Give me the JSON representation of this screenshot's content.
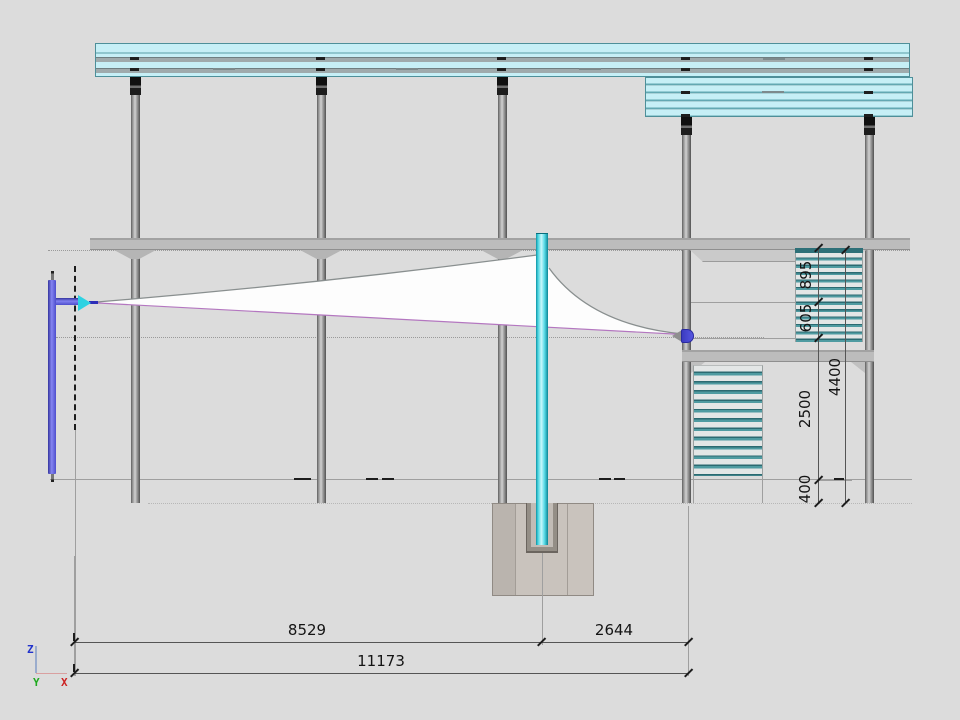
{
  "dims": {
    "bottom_8529": "8529",
    "bottom_2644": "2644",
    "bottom_total": "11173",
    "right_895": "895",
    "right_605": "605",
    "right_2500": "2500",
    "right_400": "400",
    "right_total": "4400"
  },
  "axis": {
    "z": "Z",
    "y": "Y",
    "x": "X"
  },
  "colors": {
    "background": "#dcdcdc",
    "roof_cyan": "#c6eff6",
    "roof_stripe_gray": "#9faaac",
    "louver_teal": "#4f9ba1",
    "louver_dark_teal": "#2c6a71",
    "mast_cyan": "#35cfdd",
    "member_blue": "#5656e0",
    "cable_purple": "#b477c0",
    "sail_white": "#fdfdfd",
    "column_gray": "#8a8a8a",
    "beam_gray": "#bcbcbc",
    "foundation_tan": "#c9c3bd",
    "dim_text": "#141414",
    "axis_x_red": "#cc2222",
    "axis_y_green": "#1faa1f",
    "axis_z_blue": "#2233cc"
  }
}
